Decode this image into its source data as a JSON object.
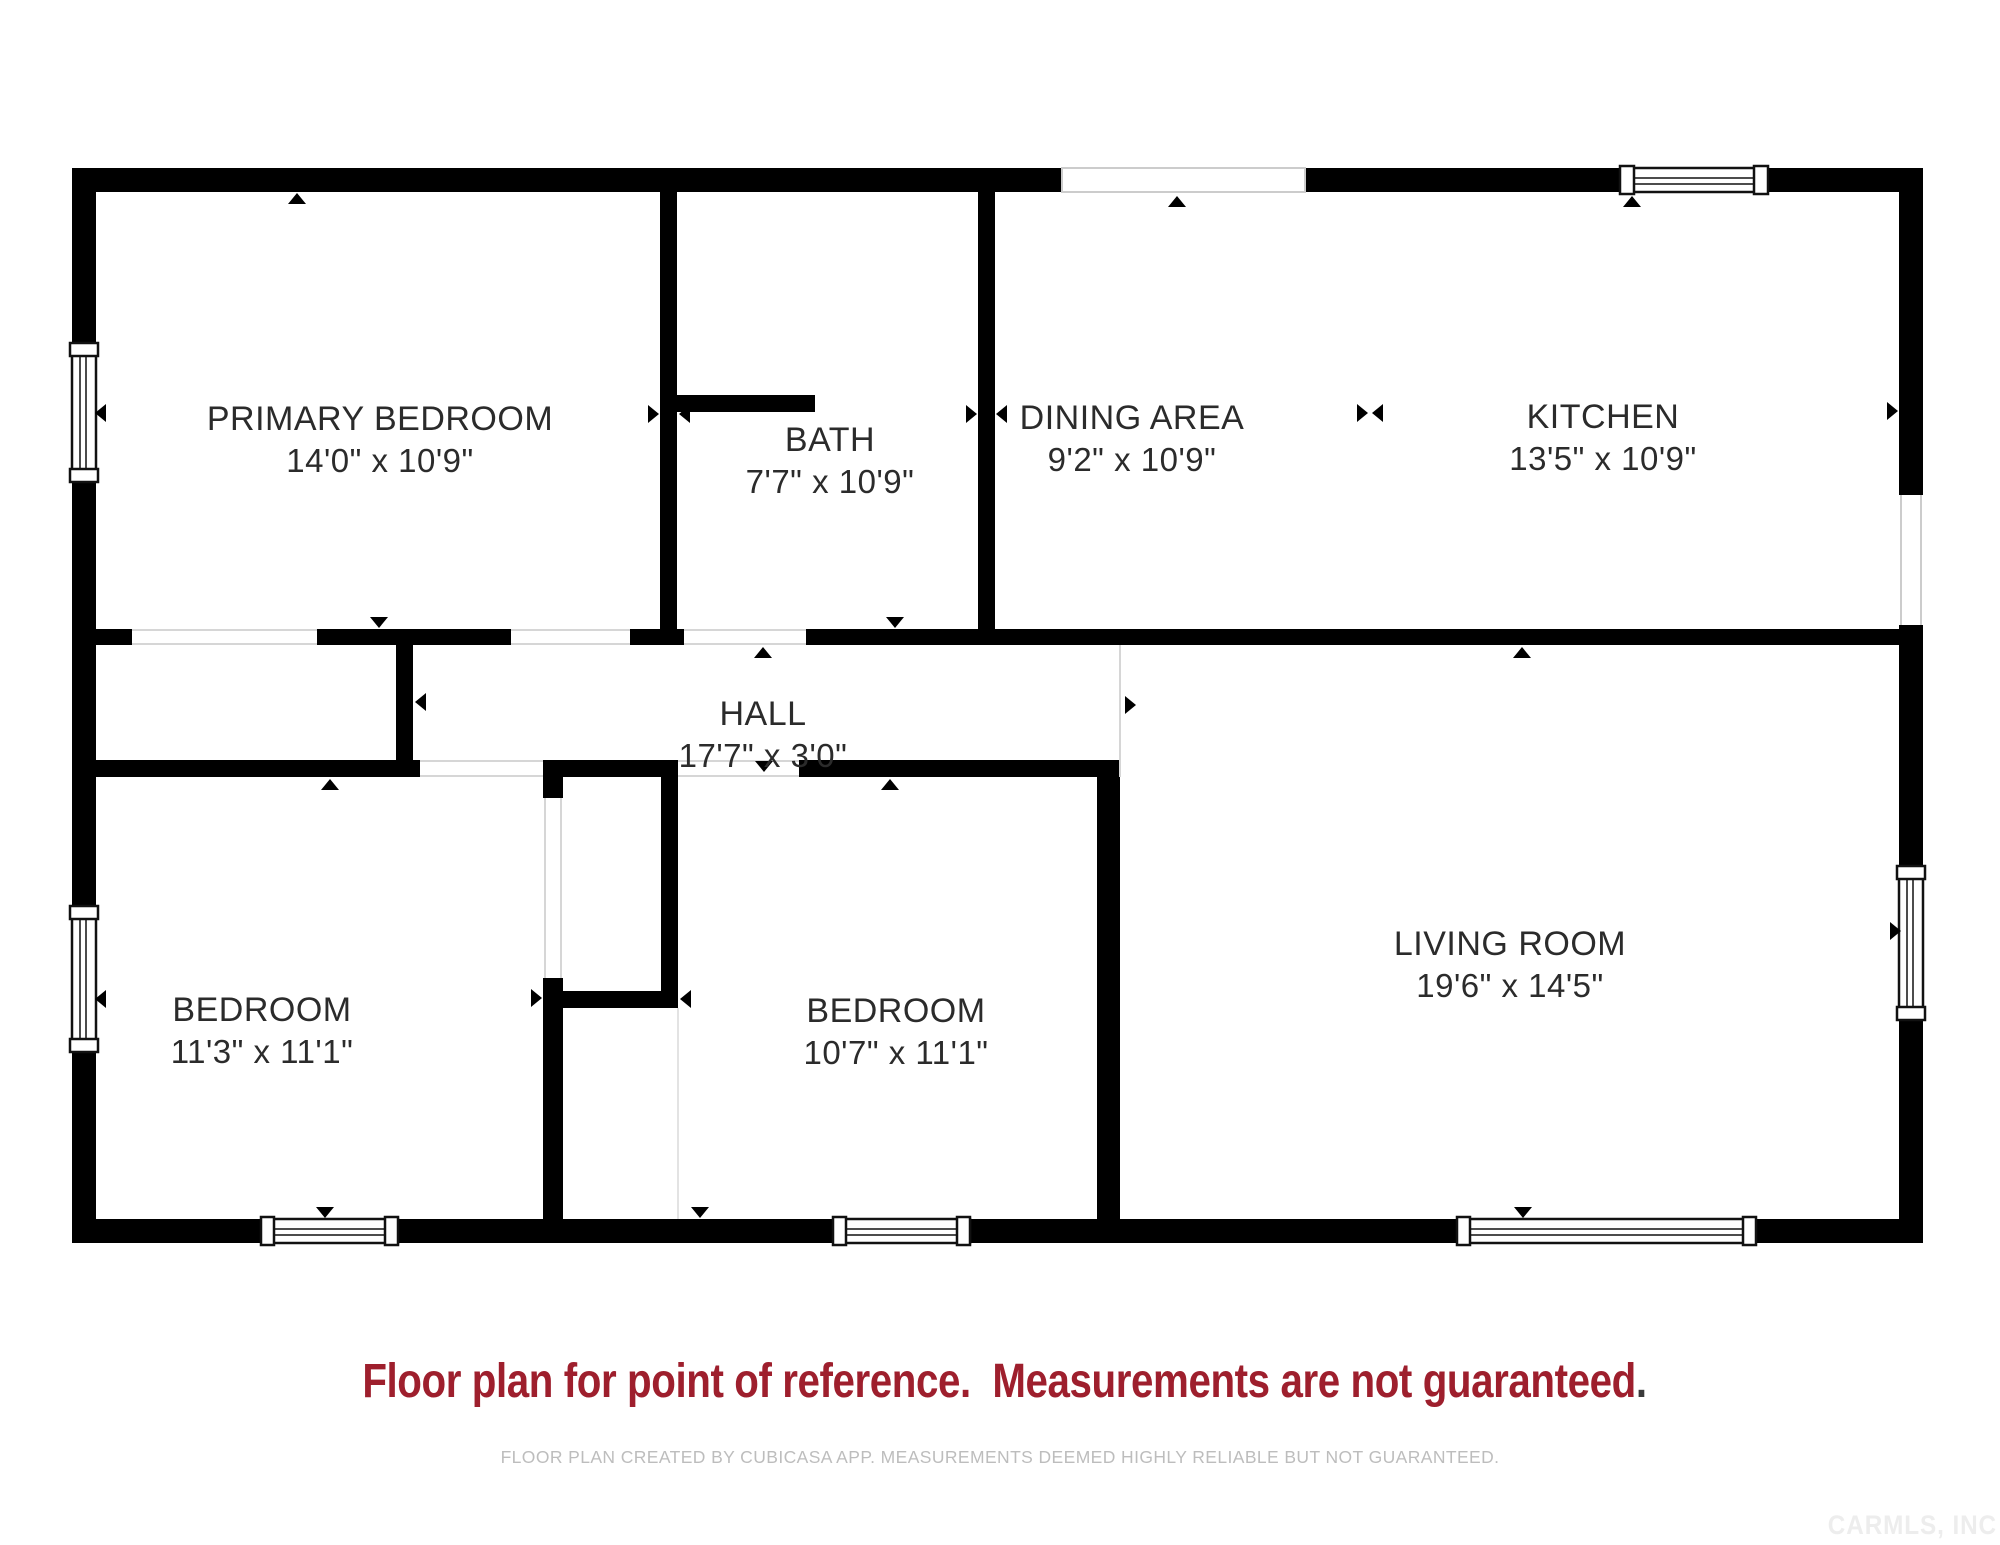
{
  "plan": {
    "rooms": [
      {
        "name": "PRIMARY BEDROOM",
        "dims": "14'0\" x 10'9\""
      },
      {
        "name": "BATH",
        "dims": "7'7\" x 10'9\""
      },
      {
        "name": "DINING AREA",
        "dims": "9'2\" x 10'9\""
      },
      {
        "name": "KITCHEN",
        "dims": "13'5\" x 10'9\""
      },
      {
        "name": "HALL",
        "dims": "17'7\" x 3'0\""
      },
      {
        "name": "BEDROOM",
        "dims": "11'3\" x 11'1\""
      },
      {
        "name": "BEDROOM",
        "dims": "10'7\" x 11'1\""
      },
      {
        "name": "LIVING ROOM",
        "dims": "19'6\" x 14'5\""
      }
    ],
    "disclaimer_main": "Floor plan for point of reference.  Measurements are not guaranteed",
    "disclaimer_period": ".",
    "footer": "FLOOR PLAN CREATED BY CUBICASA APP. MEASUREMENTS DEEMED HIGHLY RELIABLE BUT NOT GUARANTEED.",
    "watermark": "CARMLS, INC",
    "colors": {
      "wall": "#000000",
      "label_text": "#2b2b2b",
      "accent_red": "#9e1f2d",
      "footer_gray": "#bdbdbd",
      "watermark_gray": "#ededed"
    },
    "icons": {
      "door_marker": "▲",
      "measure_marker": "►◄",
      "window_marker": "▭"
    }
  }
}
